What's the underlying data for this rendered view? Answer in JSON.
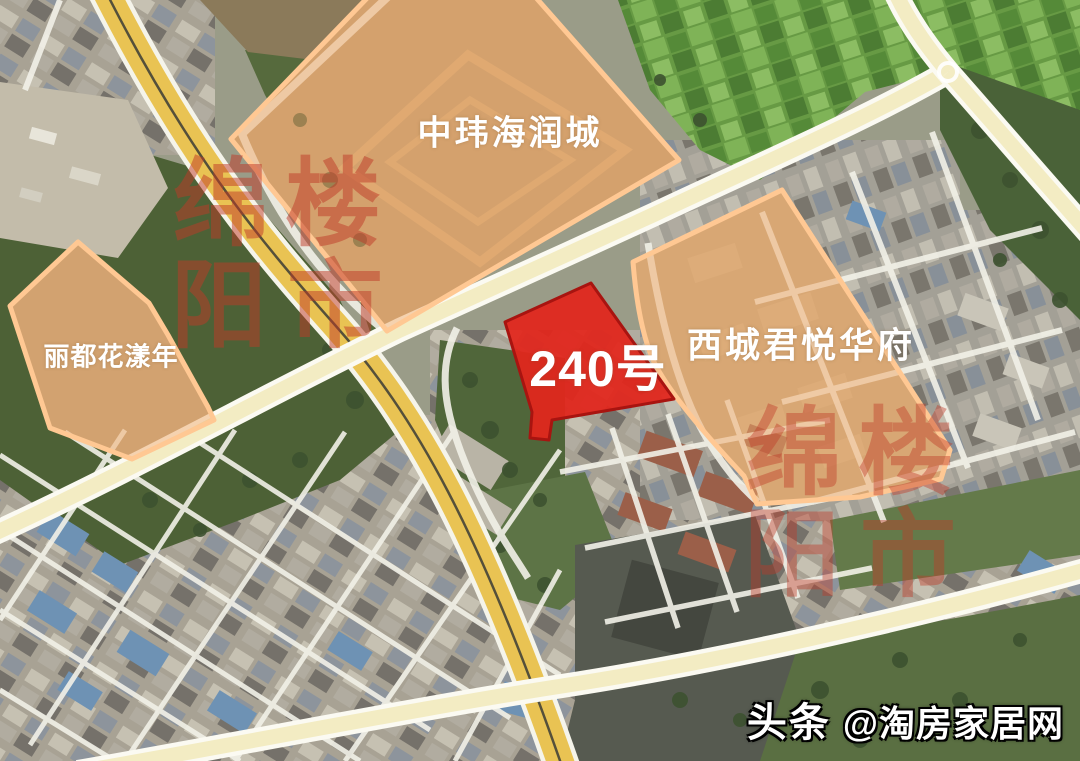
{
  "map": {
    "parcels": {
      "zhongwei": {
        "label": "中玮海润城"
      },
      "lidu": {
        "label": "丽都花漾年"
      },
      "xicheng": {
        "label": "西城君悦华府"
      },
      "lot240": {
        "label": "240号"
      }
    },
    "watermark": {
      "text": "绵阳楼市",
      "grid": [
        [
          "绵",
          "楼"
        ],
        [
          "阳",
          "市"
        ]
      ]
    },
    "credit": {
      "source": "头条",
      "handle": "@淘房家居网"
    }
  },
  "colors": {
    "parcel_fill": "#f0a96c",
    "parcel_border": "#ffc893",
    "lot240_fill": "#e1261d",
    "lot240_border": "#a81410",
    "road_major_yellow": "#e9c353",
    "road_secondary": "#f3ecc3",
    "watermark_red": "#c03a28"
  }
}
